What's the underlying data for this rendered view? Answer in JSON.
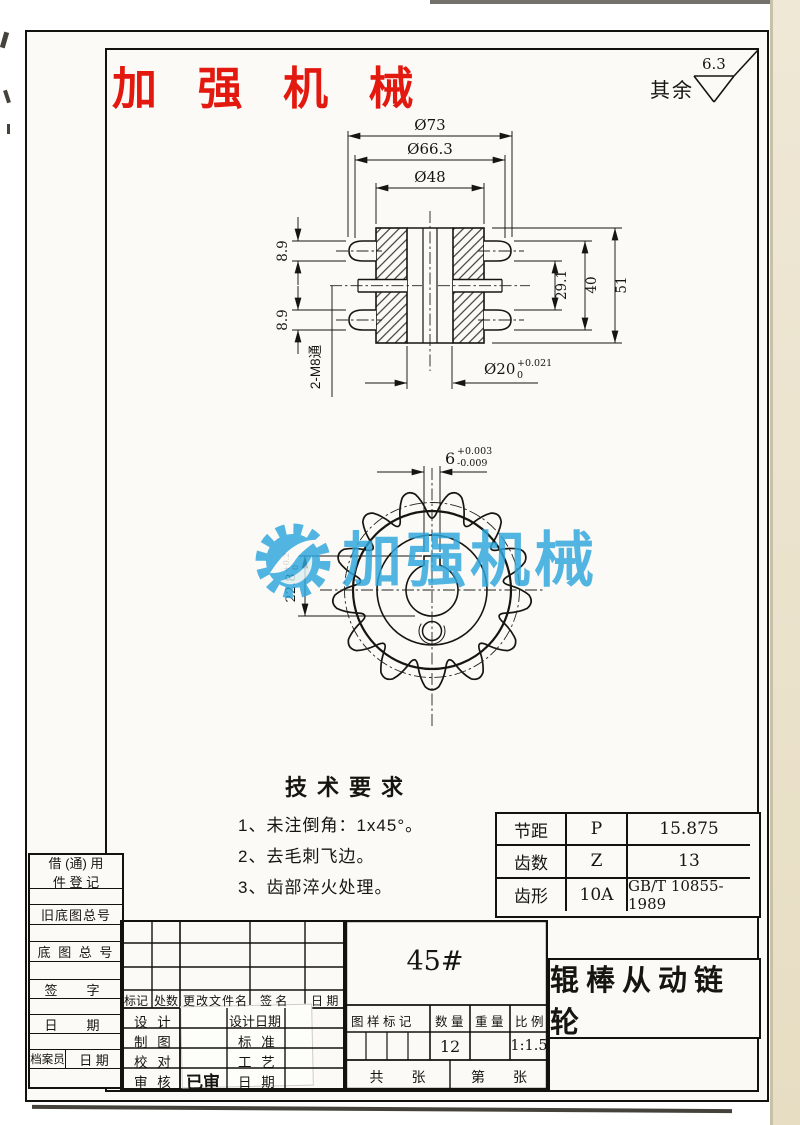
{
  "header": {
    "company": "加 强 机 械",
    "finish_label": "其余",
    "finish_value": "6.3"
  },
  "sec": {
    "d73": "Ø73",
    "d66": "Ø66.3",
    "d48": "Ø48",
    "t89a": "8.9",
    "t89b": "8.9",
    "thread": "2-M8通",
    "s291": "29.1",
    "s40": "40",
    "s51": "51",
    "bore": "Ø20",
    "boreTolUp": "+0.021",
    "boreTolDn": "0"
  },
  "front": {
    "kw": "6",
    "kwUp": "+0.003",
    "kwDn": "-0.009",
    "kd": "22.8",
    "kdUp": "+0.2",
    "kdDn": "0"
  },
  "watermark": "加强机械",
  "tech": {
    "title": "技术要求",
    "items": [
      "1、未注倒角：1x45°。",
      "2、去毛刺飞边。",
      "3、齿部淬火处理。"
    ]
  },
  "spec": {
    "r1c1": "节距",
    "r1c2": "P",
    "r1c3": "15.875",
    "r2c1": "齿数",
    "r2c2": "Z",
    "r2c3": "13",
    "r3c1": "齿形",
    "r3c2": "10A",
    "r3c3": "GB/T 10855-1989"
  },
  "register": {
    "h1a": "借 (通) 用",
    "h1b": "件 登 记",
    "r2": "旧底图总号",
    "r3": "底 图 总 号",
    "r4": "签　字",
    "r5": "日　期",
    "r6a": "档案员",
    "r6b": "日 期"
  },
  "changes": {
    "c1": "标记",
    "c2": "处数",
    "c3": "更改文件名",
    "c4": "签 名",
    "c5": "日 期"
  },
  "roles": {
    "design": "设 计",
    "draft": "制 图",
    "check": "校 对",
    "audit": "审 核",
    "audited": "已审",
    "design_date": "设计日期",
    "standard": "标 准",
    "process": "工 艺",
    "date": "日 期"
  },
  "title_block": {
    "material": "45#",
    "mark_label": "图 样 标 记",
    "qty_label": "数 量",
    "weight_label": "重 量",
    "scale_label": "比 例",
    "qty": "12",
    "scale": "1:1.5",
    "total": "共　　张",
    "page": "第　　张",
    "part_name": "辊棒从动链轮"
  }
}
